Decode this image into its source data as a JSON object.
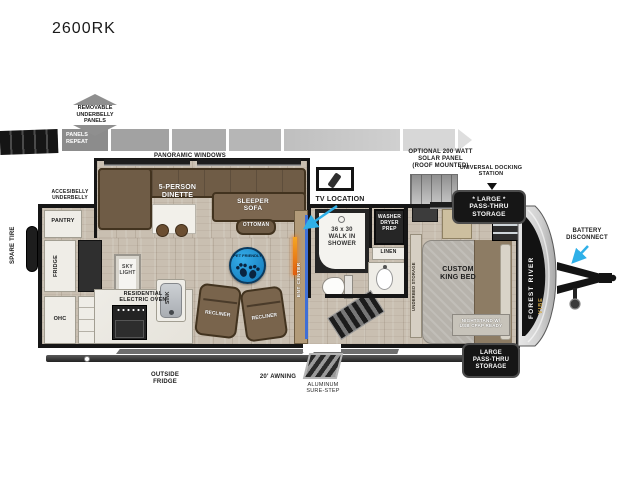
{
  "title": "2600RK",
  "colors": {
    "callout_arrow": "#2fb0e8",
    "pet_badge_blue": "#1e8fd0",
    "sofa_brown": "#6f5c46",
    "wall_black": "#161616",
    "brand_gold": "#d3a94a"
  },
  "top_annotations": {
    "removable_underbelly": "REMOVABLE\nUNDERBELLY\nPANELS",
    "panels_repeat": "PANELS\nREPEAT",
    "panoramic_windows": "PANORAMIC WINDOWS",
    "solar_panel": "OPTIONAL 200 WATT\nSOLAR PANEL\n(ROOF MOUNTED)",
    "docking_station": "UNIVERSAL DOCKING\nSTATION",
    "pass_thru_top": "* LARGE *\nPASS-THRU\nSTORAGE"
  },
  "left_annotations": {
    "accessibelly_underbelly": "ACCESIBELLY\nUNDERBELLY",
    "spare_tire": "SPARE TIRE"
  },
  "interior": {
    "pantry": "PANTRY",
    "fridge": "FRIDGE",
    "ohc": "OHC",
    "dinette": "5-PERSON\nDINETTE",
    "sleeper_sofa": "SLEEPER\nSOFA",
    "ottoman": "OTTOMAN",
    "pet_friendly": "PET FRIENDLY",
    "sky_light": "SKY\nLIGHT",
    "oven": "RESIDENTIAL\nELECTRIC OVEN",
    "sink": "SINK",
    "recliner_left": "RECLINER",
    "recliner_right": "RECLINER",
    "ent_center": "ENT CENTER",
    "tv_location": "TV LOCATION"
  },
  "bath": {
    "shower": "36 x 30\nWALK IN\nSHOWER",
    "washer_dryer": "WASHER\nDRYER\nPREP",
    "linen": "LINEN"
  },
  "bedroom": {
    "underbed_storage": "UNDERBED STORAGE",
    "king_bed": "CUSTOM\nKING BED",
    "nightstand": "NIGHTSTAND W/\nUSB CPAP READY"
  },
  "exterior": {
    "outside_fridge": "OUTSIDE\nFRIDGE",
    "awning": "20' AWNING",
    "sure_step": "ALUMINUM\nSURE-STEP",
    "pass_thru_bottom": "LARGE\nPASS-THRU\nSTORAGE",
    "battery_disconnect": "BATTERY\nDISCONNECT",
    "brand_primary": "FOREST RIVER",
    "brand_secondary": "VIBE"
  }
}
